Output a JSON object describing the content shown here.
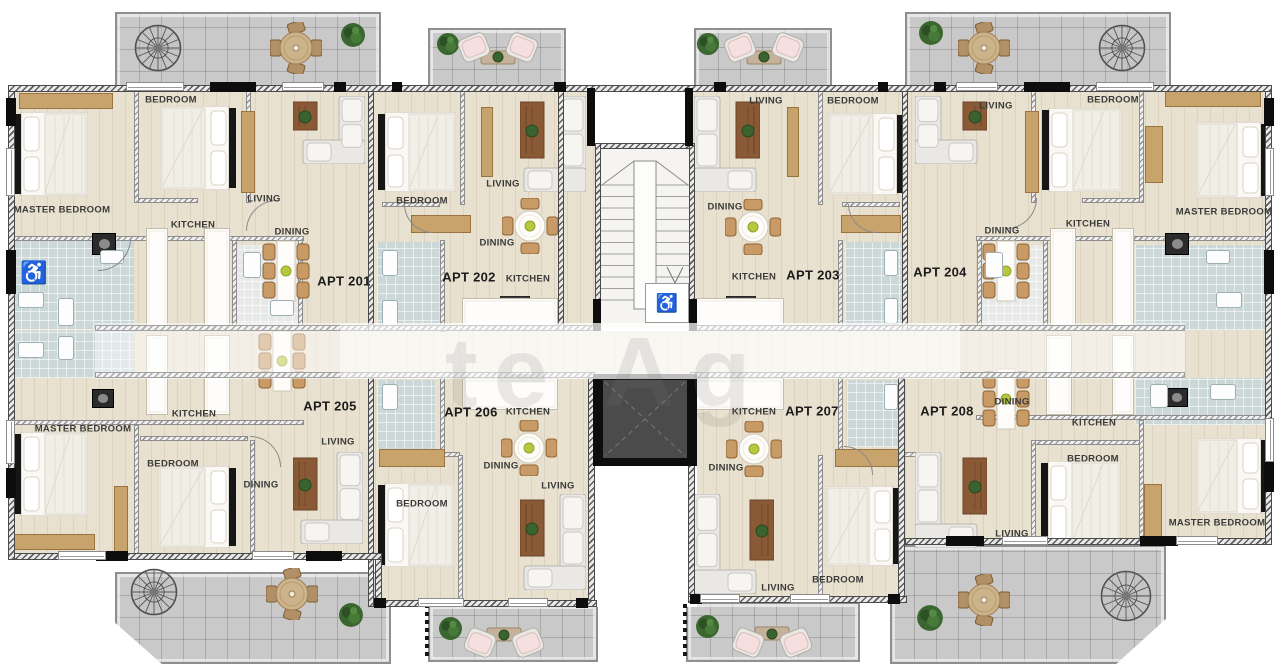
{
  "apartments": [
    {
      "id": "APT 201",
      "rooms": {
        "master_bedroom": "MASTER BEDROOM",
        "bedroom": "BEDROOM",
        "living": "LIVING",
        "kitchen": "KITCHEN",
        "dining": "DINING"
      }
    },
    {
      "id": "APT 202",
      "rooms": {
        "bedroom": "BEDROOM",
        "living": "LIVING",
        "dining": "DINING",
        "kitchen": "KITCHEN"
      }
    },
    {
      "id": "APT 203",
      "rooms": {
        "living": "LIVING",
        "bedroom": "BEDROOM",
        "dining": "DINING",
        "kitchen": "KITCHEN"
      }
    },
    {
      "id": "APT 204",
      "rooms": {
        "living": "LIVING",
        "bedroom": "BEDROOM",
        "master_bedroom": "MASTER BEDROOM",
        "kitchen": "KITCHEN",
        "dining": "DINING"
      }
    },
    {
      "id": "APT 205",
      "rooms": {
        "master_bedroom": "MASTER BEDROOM",
        "kitchen": "KITCHEN",
        "bedroom": "BEDROOM",
        "dining": "DINING",
        "living": "LIVING"
      }
    },
    {
      "id": "APT 206",
      "rooms": {
        "kitchen": "KITCHEN",
        "dining": "DINING",
        "bedroom": "BEDROOM",
        "living": "LIVING"
      }
    },
    {
      "id": "APT 207",
      "rooms": {
        "kitchen": "KITCHEN",
        "dining": "DINING",
        "living": "LIVING",
        "bedroom": "BEDROOM"
      }
    },
    {
      "id": "APT 208",
      "rooms": {
        "dining": "DINING",
        "kitchen": "KITCHEN",
        "bedroom": "BEDROOM",
        "master_bedroom": "MASTER BEDROOM",
        "living": "LIVING"
      }
    }
  ],
  "icons": {
    "wheelchair": "♿"
  },
  "watermark": {
    "fragment": "te Ag"
  }
}
